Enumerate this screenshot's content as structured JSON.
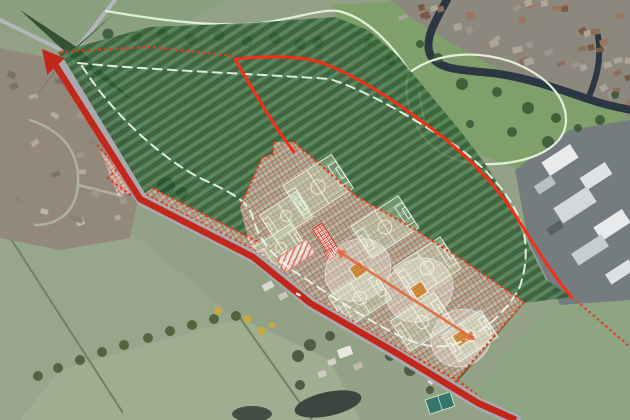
{
  "meta": {
    "description": "Aerial satellite view with sports-ground masterplan overlay: red-line site boundary, dark green hatched open space, cross-hatched pitch zone with football pitches, cricket ovals and squares, pavilion and car park, access arrow to the north-west road junction"
  },
  "colors": {
    "boundary": "#e8391e",
    "road": "#c2271a",
    "inner_line": "#ff2a12",
    "route_dash": "#eef6e8",
    "park_path": "#e3efd9",
    "green_dark": "#2c5531",
    "green_light": "#4a8050",
    "pink_bg": "rgba(255,236,230,0.52)",
    "pink_grid": "rgba(205,55,40,0.85)",
    "pitch_lines": "#eef2e2",
    "cricket_square": "#d4913f",
    "cricket_grid": "#a55f1e",
    "axis": "#e2653a",
    "river": "#2b3844",
    "pavilion_grid": "#cc3322"
  },
  "overlay": {
    "pitch_rotation_deg": -33,
    "pitches": [
      {
        "cx": 318,
        "cy": 187,
        "len": 58,
        "wid": 40
      },
      {
        "cx": 286,
        "cy": 216,
        "len": 44,
        "wid": 30
      },
      {
        "cx": 281,
        "cy": 248,
        "len": 44,
        "wid": 30
      },
      {
        "cx": 385,
        "cy": 227,
        "len": 56,
        "wid": 38
      },
      {
        "cx": 427,
        "cy": 268,
        "len": 56,
        "wid": 38
      },
      {
        "cx": 360,
        "cy": 298,
        "len": 52,
        "wid": 36
      },
      {
        "cx": 422,
        "cy": 322,
        "len": 52,
        "wid": 36
      },
      {
        "cx": 470,
        "cy": 336,
        "len": 46,
        "wid": 32
      }
    ],
    "cricket_ovals": [
      {
        "cx": 358,
        "cy": 270,
        "rx": 34,
        "ry": 30
      },
      {
        "cx": 419,
        "cy": 290,
        "rx": 35,
        "ry": 31
      },
      {
        "cx": 461,
        "cy": 338,
        "rx": 31,
        "ry": 28
      }
    ],
    "cricket_squares": [
      {
        "cx": 358,
        "cy": 270,
        "size": 13
      },
      {
        "cx": 419,
        "cy": 290,
        "size": 13
      },
      {
        "cx": 461,
        "cy": 338,
        "size": 13
      }
    ],
    "axis_arrow": {
      "x1": 338,
      "y1": 251,
      "x2": 474,
      "y2": 339
    },
    "pavilion": {
      "cx": 326,
      "cy": 240,
      "len": 33,
      "wid": 11,
      "rot": 57
    },
    "pavilion_annex": {
      "cx": 330,
      "cy": 254,
      "len": 9,
      "wid": 8,
      "rot": 57
    },
    "car_park": {
      "cx": 296,
      "cy": 256,
      "len": 36,
      "wid": 16,
      "rot": -33
    }
  }
}
